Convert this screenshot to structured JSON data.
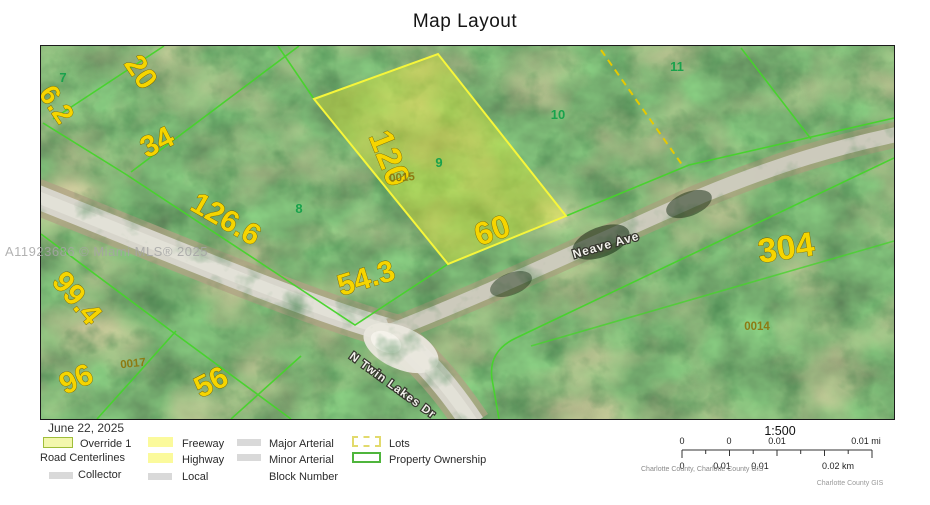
{
  "title": "Map Layout",
  "watermark": "A11923686 © Miami MLS® 2025",
  "map": {
    "streets": [
      {
        "name": "Neave Ave"
      },
      {
        "name": "N Twin Lakes Dr"
      }
    ],
    "lot_numbers": [
      {
        "value": "7"
      },
      {
        "value": "8"
      },
      {
        "value": "9"
      },
      {
        "value": "10"
      },
      {
        "value": "11"
      }
    ],
    "dimensions": [
      {
        "value": "20"
      },
      {
        "value": "6.2"
      },
      {
        "value": "34"
      },
      {
        "value": "126.6"
      },
      {
        "value": "120"
      },
      {
        "value": "60"
      },
      {
        "value": "54.3"
      },
      {
        "value": "99.4"
      },
      {
        "value": "96"
      },
      {
        "value": "56"
      },
      {
        "value": "304"
      }
    ],
    "block_numbers": [
      {
        "value": "0015"
      },
      {
        "value": "0017"
      },
      {
        "value": "0014"
      }
    ]
  },
  "legend": {
    "date": "June 22, 2025",
    "override": {
      "label": "Override 1"
    },
    "road_centerlines_header": "Road Centerlines",
    "road_types": [
      {
        "label": "Collector"
      },
      {
        "label": "Freeway"
      },
      {
        "label": "Highway"
      },
      {
        "label": "Local"
      },
      {
        "label": "Major Arterial"
      },
      {
        "label": "Minor Arterial"
      }
    ],
    "block_number": {
      "label": "Block Number"
    },
    "lots": {
      "label": "Lots"
    },
    "property_ownership": {
      "label": "Property Ownership"
    }
  },
  "scalebar": {
    "ratio": "1:500",
    "mi_ticks": [
      "0",
      "0",
      "0.01",
      "0.01 mi"
    ],
    "km_ticks": [
      "0",
      "0.01",
      "0.01",
      "0.02 km"
    ],
    "attribution": "Charlotte County, Charlotte County GIS",
    "credit": "Charlotte County GIS"
  },
  "colors": {
    "dimension_text": "#f6d500",
    "lot_number_text": "#19a24c",
    "block_number_text": "#8d7a12",
    "parcel_line": "#46d42b",
    "highlight_fill": "#e1e632",
    "highlight_border": "#f6f63a",
    "lots_dash": "#e2da6c",
    "ownership_green": "#4fb53c"
  }
}
